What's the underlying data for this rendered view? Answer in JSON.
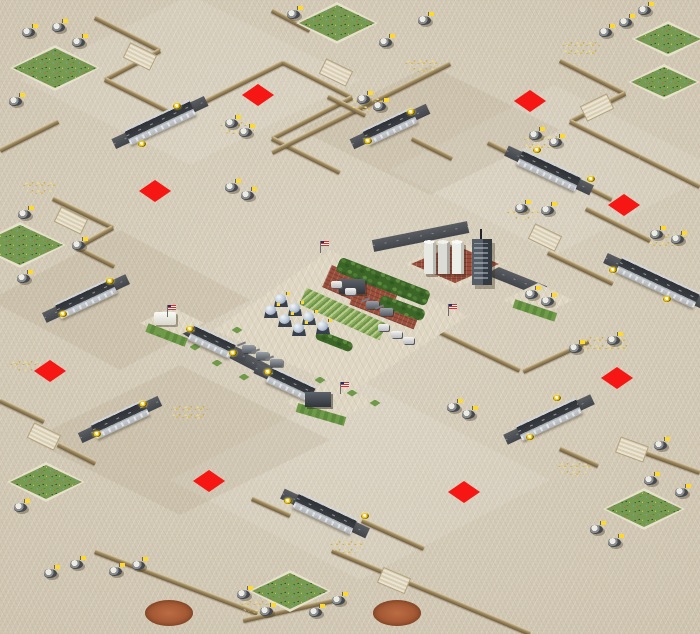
{
  "map": {
    "width": 700,
    "height": 634,
    "description": "isometric-desert-rts-map",
    "colors": {
      "sand": "#d6cdba",
      "sand_light": "#e8e1cc",
      "cliff": "#6d5b3c",
      "road_deck": "#3a3e43",
      "bridge_rail": "#caced2",
      "spawn_red": "#f51010",
      "grass_green": "#769a50",
      "tree_green": "#3c6628",
      "crop_green": "#8aab5c",
      "brick_red": "#9a4e3a",
      "dirt_brown": "#a65a35",
      "ore_gold": "#e0c468",
      "light_yellow": "#f4c71e",
      "flag_yellow": "#ffd92b"
    },
    "tint_plates": [
      {
        "x": 190,
        "y": 80,
        "w": 340,
        "h": 170,
        "t": "l"
      },
      {
        "x": 555,
        "y": 170,
        "w": 330,
        "h": 170,
        "t": "l"
      },
      {
        "x": 120,
        "y": 300,
        "w": 260,
        "h": 140,
        "t": "d"
      },
      {
        "x": 430,
        "y": 130,
        "w": 260,
        "h": 130,
        "t": "d"
      },
      {
        "x": 360,
        "y": 480,
        "w": 380,
        "h": 200,
        "t": "l"
      },
      {
        "x": 180,
        "y": 440,
        "w": 300,
        "h": 150,
        "t": "d"
      }
    ],
    "cliffs": [
      [
        95,
        17,
        160,
        50
      ],
      [
        160,
        50,
        105,
        79
      ],
      [
        105,
        79,
        175,
        114
      ],
      [
        175,
        114,
        131,
        137
      ],
      [
        191,
        108,
        283,
        62
      ],
      [
        283,
        62,
        352,
        97
      ],
      [
        352,
        97,
        272,
        138
      ],
      [
        272,
        138,
        340,
        172
      ],
      [
        272,
        10,
        310,
        30
      ],
      [
        450,
        63,
        348,
        114
      ],
      [
        348,
        114,
        272,
        152
      ],
      [
        328,
        96,
        366,
        115
      ],
      [
        412,
        138,
        452,
        158
      ],
      [
        560,
        60,
        625,
        93
      ],
      [
        625,
        93,
        570,
        121
      ],
      [
        570,
        121,
        640,
        156
      ],
      [
        640,
        156,
        700,
        186
      ],
      [
        488,
        142,
        520,
        158
      ],
      [
        578,
        182,
        612,
        199
      ],
      [
        586,
        208,
        650,
        240
      ],
      [
        548,
        252,
        613,
        283
      ],
      [
        0,
        150,
        58,
        121
      ],
      [
        53,
        198,
        113,
        227
      ],
      [
        113,
        227,
        77,
        247
      ],
      [
        77,
        247,
        115,
        266
      ],
      [
        437,
        330,
        520,
        370
      ],
      [
        523,
        371,
        588,
        341
      ],
      [
        0,
        400,
        44,
        421
      ],
      [
        58,
        444,
        96,
        463
      ],
      [
        95,
        551,
        258,
        613
      ],
      [
        332,
        550,
        530,
        633
      ],
      [
        243,
        620,
        333,
        600
      ],
      [
        620,
        443,
        700,
        472
      ],
      [
        560,
        448,
        598,
        465
      ],
      [
        252,
        498,
        290,
        515
      ],
      [
        362,
        520,
        424,
        548
      ]
    ],
    "ramps": [
      [
        140,
        56,
        26
      ],
      [
        336,
        72,
        26
      ],
      [
        71,
        220,
        26
      ],
      [
        545,
        237,
        26
      ],
      [
        597,
        107,
        -26
      ],
      [
        394,
        580,
        23
      ],
      [
        44,
        436,
        26
      ],
      [
        632,
        449,
        20
      ]
    ],
    "roads": [
      [
        188,
        330,
        318,
        397
      ],
      [
        480,
        266,
        545,
        292
      ],
      [
        373,
        246,
        468,
        227
      ]
    ],
    "bridges": [
      {
        "x": 160,
        "y": 122,
        "len": 72,
        "dir": "ne"
      },
      {
        "x": 390,
        "y": 126,
        "len": 54,
        "dir": "ne"
      },
      {
        "x": 549,
        "y": 170,
        "len": 64,
        "dir": "se"
      },
      {
        "x": 658,
        "y": 282,
        "len": 86,
        "dir": "se"
      },
      {
        "x": 86,
        "y": 298,
        "len": 62,
        "dir": "ne"
      },
      {
        "x": 212,
        "y": 341,
        "len": 46,
        "dir": "se"
      },
      {
        "x": 291,
        "y": 384,
        "len": 48,
        "dir": "se"
      },
      {
        "x": 120,
        "y": 419,
        "len": 58,
        "dir": "ne"
      },
      {
        "x": 549,
        "y": 419,
        "len": 66,
        "dir": "ne"
      },
      {
        "x": 325,
        "y": 513,
        "len": 64,
        "dir": "se"
      }
    ],
    "lights": [
      [
        177,
        106
      ],
      [
        142,
        144
      ],
      [
        411,
        112
      ],
      [
        368,
        141
      ],
      [
        537,
        150
      ],
      [
        591,
        179
      ],
      [
        613,
        270
      ],
      [
        667,
        299
      ],
      [
        110,
        281
      ],
      [
        63,
        314
      ],
      [
        190,
        329
      ],
      [
        233,
        353
      ],
      [
        268,
        372
      ],
      [
        313,
        396
      ],
      [
        143,
        404
      ],
      [
        97,
        434
      ],
      [
        557,
        398
      ],
      [
        530,
        437
      ],
      [
        288,
        501
      ],
      [
        365,
        516
      ]
    ],
    "spawn_points": [
      [
        258,
        95
      ],
      [
        530,
        101
      ],
      [
        155,
        191
      ],
      [
        624,
        205
      ],
      [
        50,
        371
      ],
      [
        617,
        378
      ],
      [
        209,
        481
      ],
      [
        464,
        492
      ]
    ],
    "grass_patches": [
      [
        55,
        68,
        90,
        46
      ],
      [
        337,
        23,
        82,
        42
      ],
      [
        668,
        39,
        72,
        36
      ],
      [
        664,
        82,
        72,
        36
      ],
      [
        20,
        245,
        92,
        46
      ],
      [
        46,
        482,
        78,
        40
      ],
      [
        290,
        591,
        82,
        42
      ],
      [
        644,
        509,
        82,
        42
      ]
    ],
    "dirt_circles": [
      [
        169,
        613,
        48,
        26
      ],
      [
        397,
        613,
        48,
        26
      ]
    ],
    "ore_patches": [
      [
        40,
        187,
        34,
        14
      ],
      [
        238,
        127,
        36,
        15
      ],
      [
        582,
        48,
        40,
        16
      ],
      [
        422,
        65,
        34,
        14
      ],
      [
        368,
        103,
        36,
        15
      ],
      [
        543,
        142,
        40,
        16
      ],
      [
        523,
        213,
        32,
        13
      ],
      [
        667,
        240,
        40,
        16
      ],
      [
        605,
        344,
        48,
        18
      ],
      [
        575,
        468,
        34,
        14
      ],
      [
        190,
        412,
        40,
        16
      ],
      [
        348,
        546,
        36,
        14
      ],
      [
        25,
        365,
        30,
        13
      ],
      [
        258,
        606,
        34,
        14
      ]
    ],
    "units": [
      [
        30,
        31
      ],
      [
        60,
        26
      ],
      [
        80,
        41
      ],
      [
        17,
        100
      ],
      [
        295,
        13
      ],
      [
        426,
        19
      ],
      [
        387,
        41
      ],
      [
        646,
        9
      ],
      [
        627,
        21
      ],
      [
        607,
        31
      ],
      [
        365,
        98
      ],
      [
        381,
        105
      ],
      [
        233,
        122
      ],
      [
        247,
        131
      ],
      [
        537,
        134
      ],
      [
        557,
        141
      ],
      [
        523,
        207
      ],
      [
        549,
        209
      ],
      [
        658,
        233
      ],
      [
        679,
        238
      ],
      [
        26,
        213
      ],
      [
        25,
        277
      ],
      [
        80,
        244
      ],
      [
        233,
        186
      ],
      [
        249,
        194
      ],
      [
        117,
        570
      ],
      [
        140,
        564
      ],
      [
        52,
        572
      ],
      [
        78,
        563
      ],
      [
        245,
        593
      ],
      [
        268,
        610
      ],
      [
        317,
        611
      ],
      [
        340,
        599
      ],
      [
        662,
        444
      ],
      [
        652,
        479
      ],
      [
        683,
        491
      ],
      [
        598,
        528
      ],
      [
        616,
        541
      ],
      [
        22,
        506
      ],
      [
        455,
        406
      ],
      [
        470,
        413
      ],
      [
        577,
        347
      ],
      [
        615,
        339
      ],
      [
        533,
        293
      ],
      [
        549,
        300
      ]
    ],
    "central_base": {
      "platform_pts": [
        [
          214,
          330
        ],
        [
          330,
          250
        ],
        [
          468,
          316
        ],
        [
          352,
          392
        ]
      ],
      "brick_platform": {
        "x": 455,
        "y": 264,
        "w": 100,
        "h": 50
      },
      "side_platforms": [
        {
          "x": 172,
          "y": 323,
          "w": 64,
          "h": 32
        },
        {
          "x": 538,
          "y": 300,
          "w": 70,
          "h": 34
        },
        {
          "x": 330,
          "y": 402,
          "w": 90,
          "h": 44
        }
      ],
      "tree_rows": [
        [
          338,
          264,
          428,
          299,
          16
        ],
        [
          380,
          300,
          424,
          316,
          12
        ],
        [
          316,
          334,
          352,
          348,
          10
        ]
      ],
      "crop_field": [
        303,
        296,
        383,
        332,
        18
      ],
      "brick_pads": [
        [
          327,
          276,
          393,
          305,
          24
        ],
        [
          353,
          295,
          417,
          320,
          20
        ]
      ],
      "green_strips": [
        [
          147,
          327,
          186,
          342,
          9
        ],
        [
          297,
          407,
          345,
          421,
          9
        ],
        [
          514,
          303,
          556,
          317,
          9
        ]
      ],
      "green_squares": [
        [
          217,
          363
        ],
        [
          244,
          377
        ],
        [
          320,
          380
        ],
        [
          352,
          393
        ],
        [
          237,
          330
        ],
        [
          160,
          332
        ],
        [
          195,
          347
        ],
        [
          375,
          403
        ]
      ],
      "domes": [
        [
          281,
          301
        ],
        [
          295,
          310
        ],
        [
          309,
          319
        ],
        [
          323,
          328
        ],
        [
          271,
          312
        ],
        [
          285,
          321
        ],
        [
          299,
          330
        ]
      ],
      "silos": {
        "x": 446,
        "y": 258
      },
      "tower": {
        "x": 482,
        "y": 262
      },
      "white_buildings": [
        [
          165,
          318
        ]
      ],
      "dark_buildings": [
        [
          318,
          399
        ],
        [
          352,
          286
        ]
      ],
      "cars": [
        [
          383,
          327
        ],
        [
          396,
          334
        ],
        [
          408,
          340
        ],
        [
          336,
          284
        ],
        [
          350,
          291
        ]
      ],
      "artillery": [
        [
          248,
          349
        ],
        [
          262,
          356
        ],
        [
          276,
          363
        ],
        [
          372,
          305
        ],
        [
          386,
          312
        ]
      ],
      "us_flags": [
        [
          325,
          247
        ],
        [
          172,
          311
        ],
        [
          453,
          310
        ],
        [
          345,
          388
        ]
      ]
    }
  }
}
